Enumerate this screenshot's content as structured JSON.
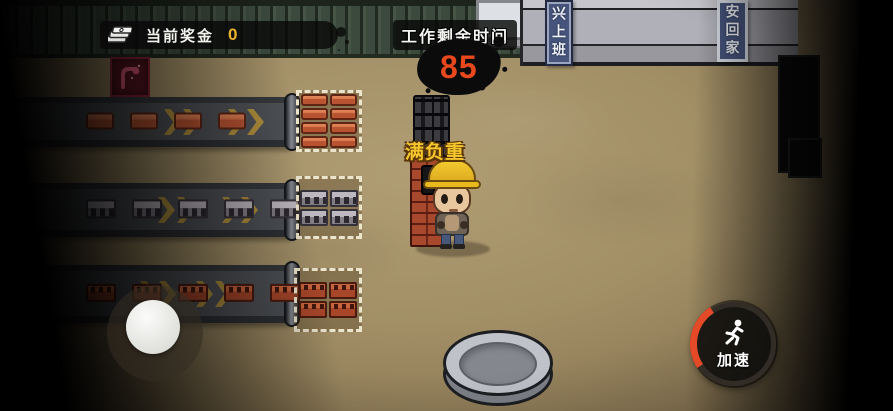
{
  "hud": {
    "bonus": {
      "icon": "money-stack-icon",
      "label": "当前奖金",
      "value": "0"
    },
    "timer": {
      "label": "工作剩余时间",
      "value": "85"
    },
    "character_status": "满负重",
    "speed_button": {
      "icon": "runner-icon",
      "label": "加速"
    }
  },
  "signs": {
    "work": "兴上班",
    "home": "安回家"
  },
  "poster": {
    "icon": "flex-arm-icon"
  },
  "conveyors": [
    {
      "name": "red-brick-conveyor",
      "item_type": "red-brick",
      "item_count": 4,
      "direction": "right"
    },
    {
      "name": "cinder-block-conveyor",
      "item_type": "cinder-block",
      "item_count": 5,
      "direction": "right"
    },
    {
      "name": "perforated-brick-conveyor",
      "item_type": "perforated-brick",
      "item_count": 5,
      "direction": "right"
    }
  ],
  "dropzones": [
    {
      "name": "red-brick-zone",
      "item_type": "red-brick",
      "rows": 4,
      "cols": 2
    },
    {
      "name": "cinder-block-zone",
      "item_type": "cinder-block",
      "rows": 2,
      "cols": 2
    },
    {
      "name": "perforated-brick-zone",
      "item_type": "perforated-brick",
      "rows": 2,
      "cols": 2
    }
  ],
  "colors": {
    "bonus_value": "#ecb22a",
    "timer_value": "#e8481c",
    "status_label": "#f4c62c",
    "speed_arc": "#e44a27",
    "sign_bg": "#47557d",
    "ground": "#a28f66"
  }
}
